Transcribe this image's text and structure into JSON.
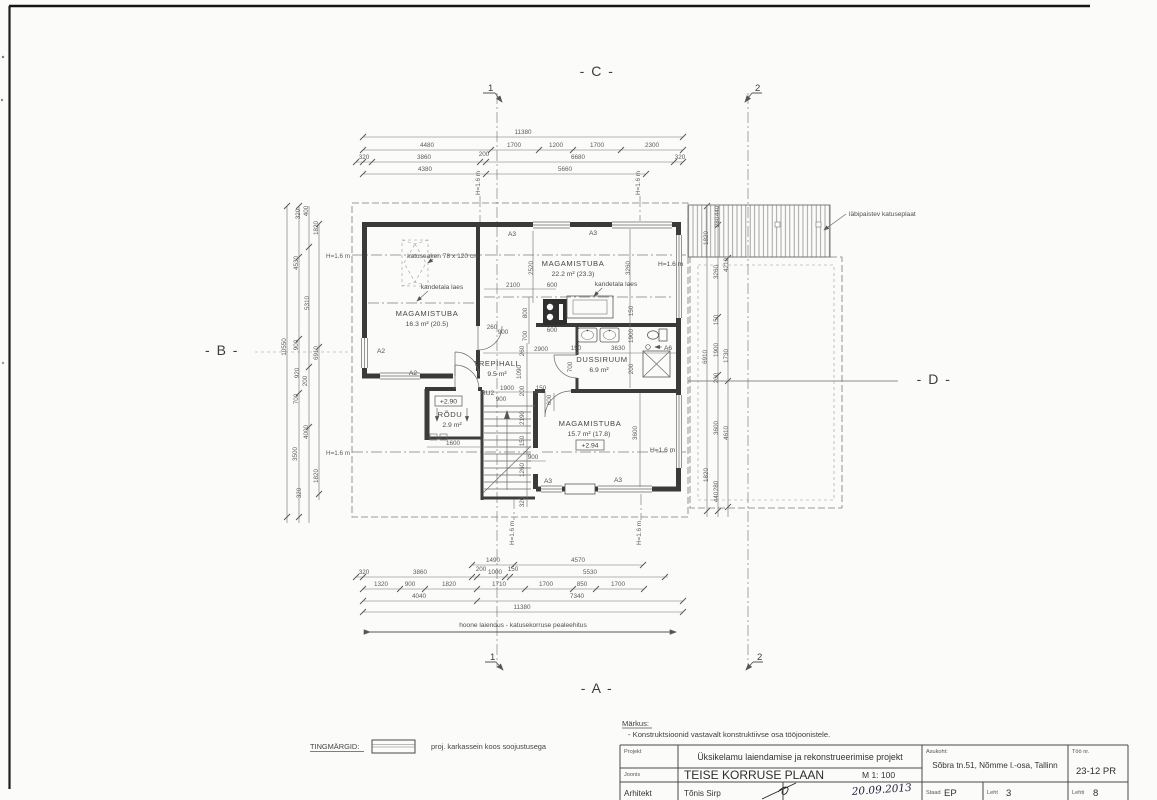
{
  "axes": {
    "top": "- C -",
    "bottom": "- A -",
    "left": "- B -",
    "right": "- D -"
  },
  "sections": {
    "s1": "1",
    "s2": "2"
  },
  "rooms": {
    "bed1": {
      "name": "MAGAMISTUBA",
      "area": "16.3 m² (20.5)"
    },
    "bed2": {
      "name": "MAGAMISTUBA",
      "area": "22.2 m² (23.3)"
    },
    "bed3": {
      "name": "MAGAMISTUBA",
      "area": "15.7 m² (17.8)"
    },
    "hall": {
      "name": "TREPIHALL",
      "area": "9.5 m²"
    },
    "shower": {
      "name": "DUSSIRUUM",
      "area": "6.9 m²"
    },
    "balcony": {
      "name": "RÕDU",
      "area": "2.9 m²"
    }
  },
  "levels": {
    "balcony": "+2.90",
    "bed3": "+2.94"
  },
  "tags": {
    "a2": "A2",
    "a3": "A3",
    "a6": "A6",
    "ru2": "RU2",
    "h": "H=1.6 m"
  },
  "ann": {
    "roof_window": "katuseaken 78 x 120 cm",
    "beam": "kandetala laes",
    "roof_plate": "läbipaistev katuseplaat",
    "extension": "hoone laiendus - katusekorruse pealeehitus"
  },
  "dims": {
    "top_total": "11380",
    "top_r2": [
      "4480",
      "1700",
      "1200",
      "1700",
      "2300"
    ],
    "top_r3": [
      "320",
      "3860",
      "200",
      "6680",
      "320"
    ],
    "top_r4": [
      "4380",
      "5660"
    ],
    "bot_r1": [
      "1490",
      "4570"
    ],
    "bot_r2": [
      "320",
      "3860",
      "200",
      "1000",
      "150",
      "5530"
    ],
    "bot_r3": [
      "1320",
      "900",
      "1820",
      "1710",
      "1700",
      "850",
      "1700"
    ],
    "bot_r4": [
      "4040",
      "7340"
    ],
    "bot_total": "11380",
    "left": [
      "10550",
      "320",
      "400",
      "4530",
      "5310",
      "900",
      "920",
      "200",
      "700",
      "4000",
      "3500",
      "1820",
      "6910",
      "1820",
      "320"
    ],
    "right": [
      "440",
      "280",
      "1820",
      "3260",
      "4210",
      "150",
      "1900",
      "1730",
      "6910",
      "200",
      "3600",
      "4610",
      "1820",
      "280",
      "440"
    ],
    "plan": [
      "2520",
      "3260",
      "2100",
      "600",
      "800",
      "700",
      "600",
      "260",
      "900",
      "260",
      "2900",
      "150",
      "3630",
      "150",
      "1900",
      "200",
      "700",
      "1090",
      "1900",
      "200",
      "150",
      "900",
      "600",
      "2190",
      "150",
      "1260",
      "320",
      "900",
      "3600",
      "1600"
    ]
  },
  "legend": {
    "title": "TINGMÄRGID:",
    "item": "proj. karkassein koos soojustusega"
  },
  "notes": {
    "title": "Märkus:",
    "line1": "- Konstruktsioonid vastavalt konstruktiivse osa tööjoonistele."
  },
  "titleblock": {
    "projekt_label": "Projekt",
    "projekt": "Üksikelamu laiendamise ja rekonstrueerimise projekt",
    "joonis_label": "Joonis",
    "joonis": "TEISE KORRUSE PLAAN",
    "scale": "M 1: 100",
    "asukoht_label": "Asukoht:",
    "asukoht": "Sõbra tn.51, Nõmme l.-osa, Tallinn",
    "too_label": "Töö nr.",
    "too": "23-12 PR",
    "arhitekt_label": "Arhitekt",
    "arhitekt": "Tõnis Sirp",
    "date": "20.09.2013",
    "staad_label": "Staad",
    "staad": "EP",
    "leht_label": "Leht",
    "leht": "3",
    "lehti_label": "Lehti",
    "lehti": "8"
  }
}
